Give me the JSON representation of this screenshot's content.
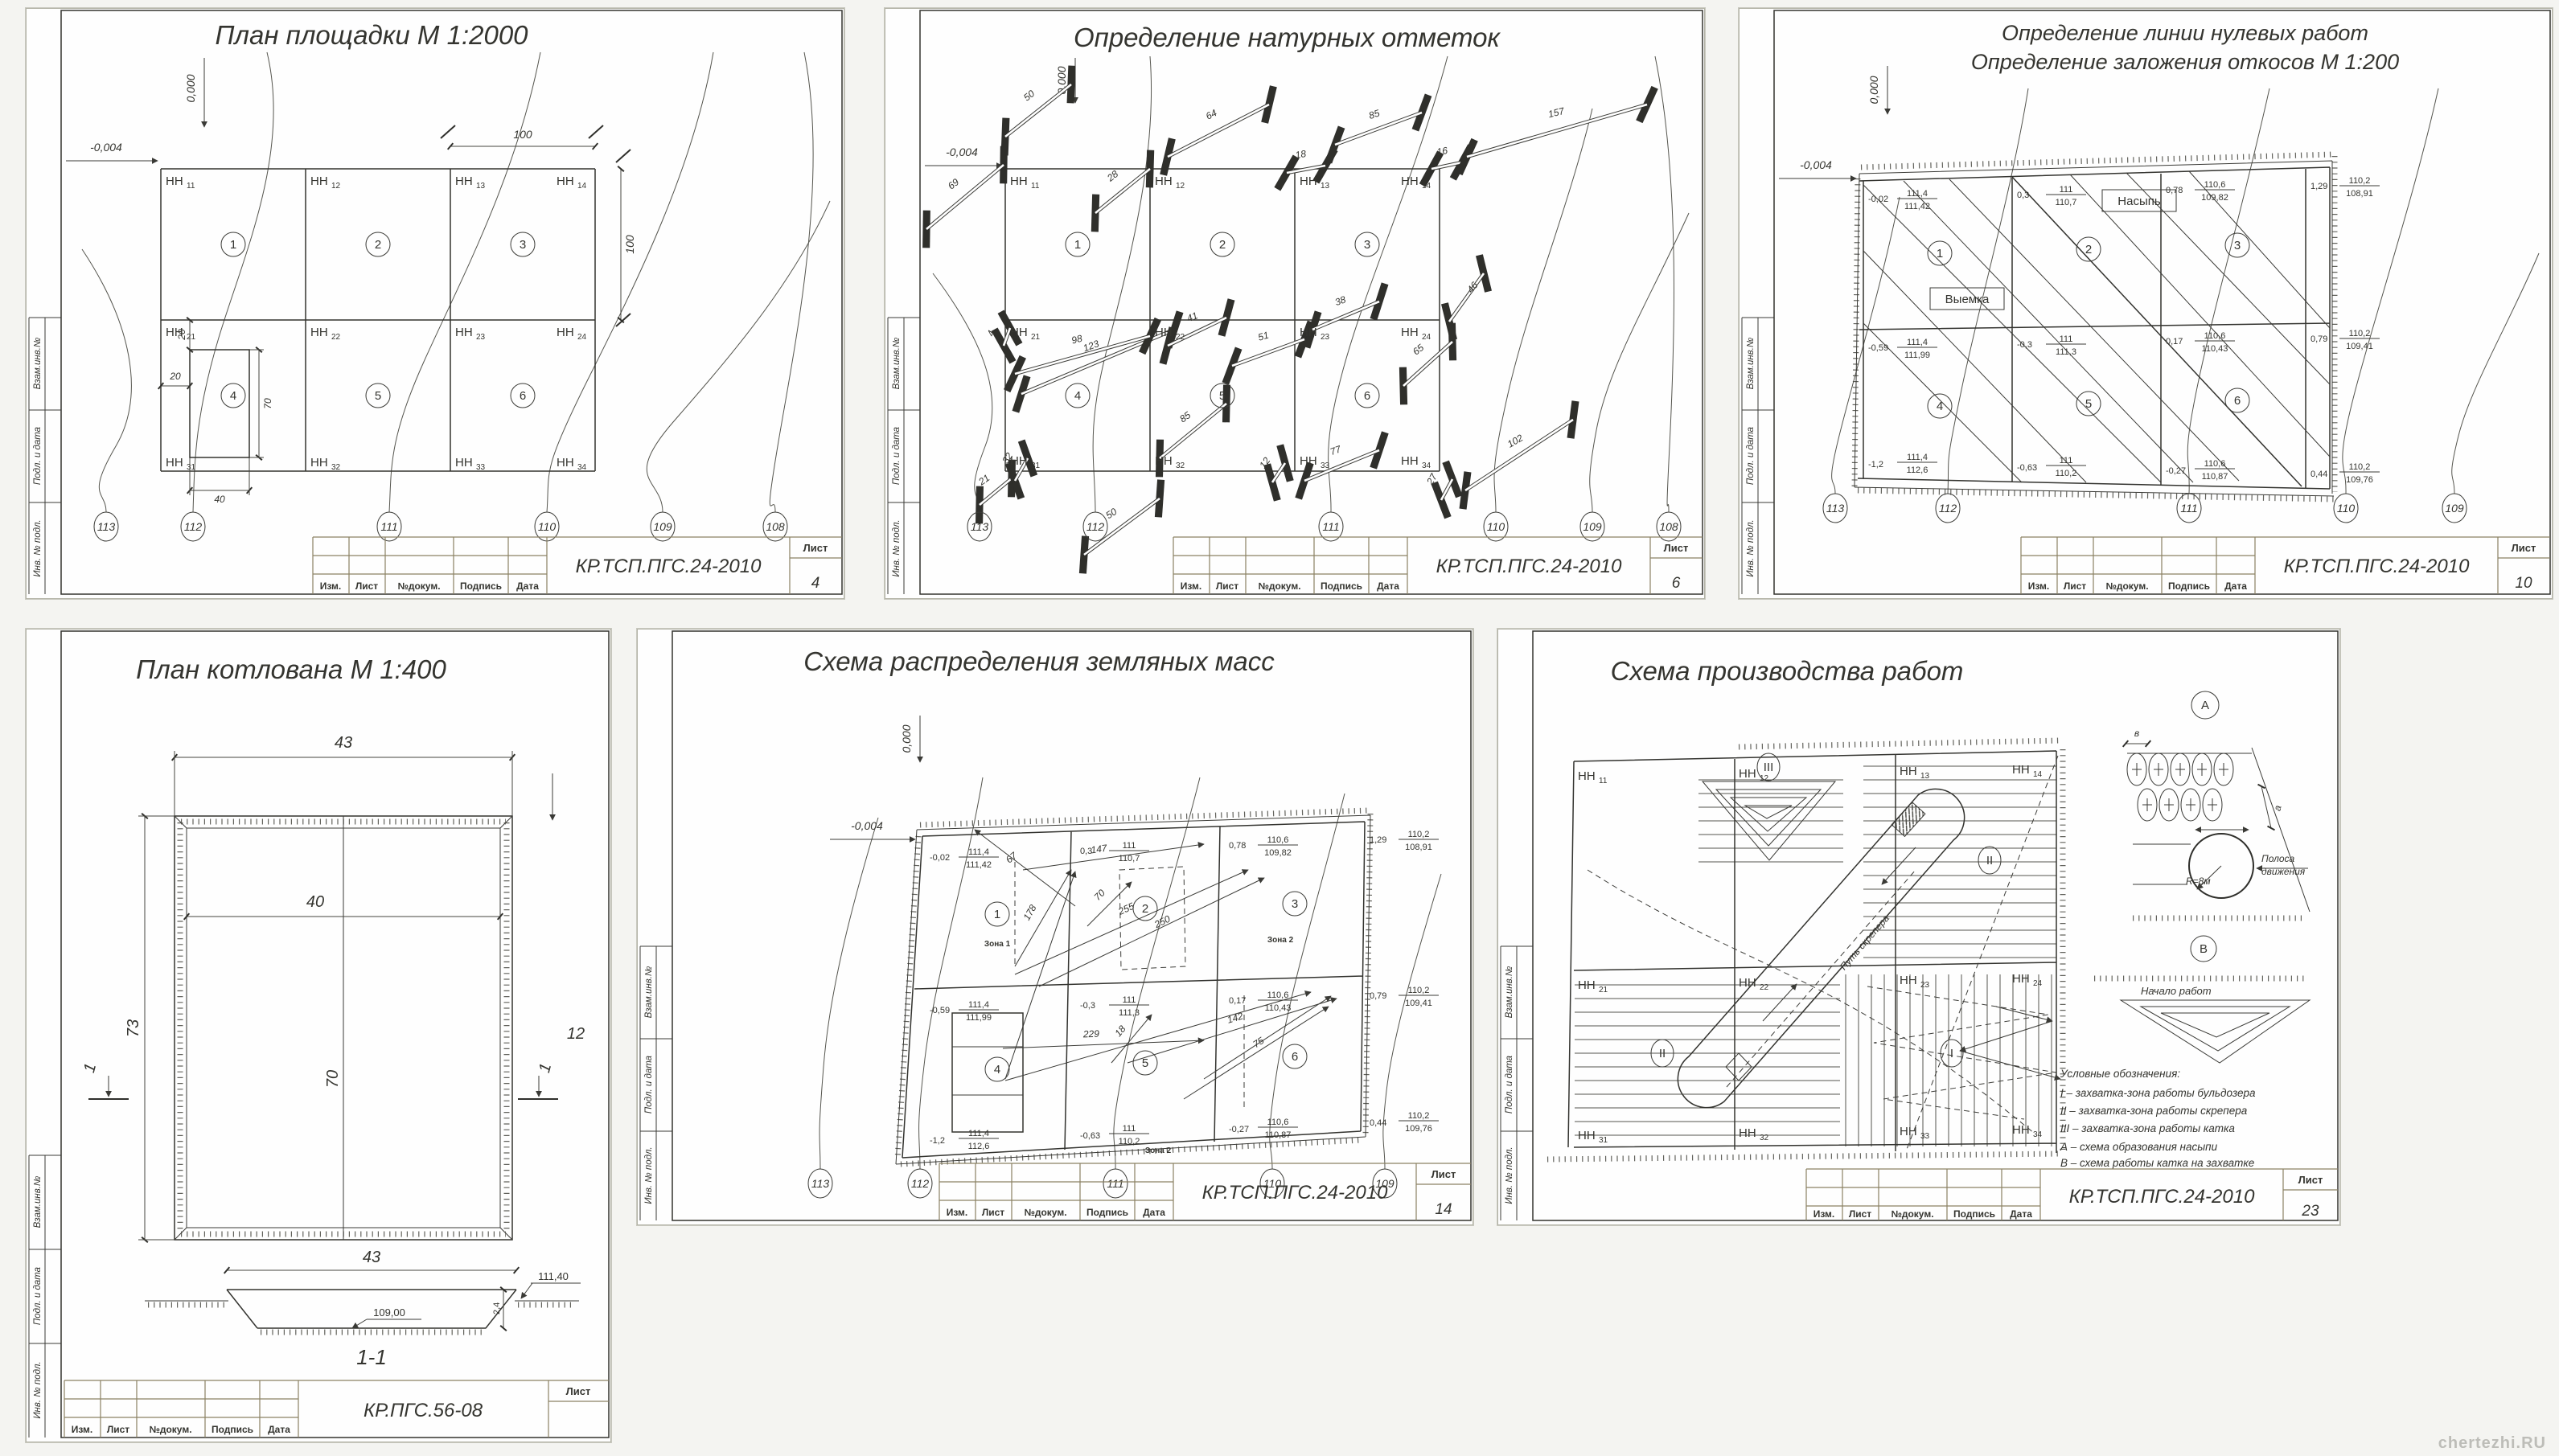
{
  "common": {
    "doc_code": "КР.ТСП.ПГС.24-2010",
    "doc_code_s4": "КР.ПГС.56-08",
    "tb_cols": [
      "Изм.",
      "Лист",
      "№докум.",
      "Подпись",
      "Дата"
    ],
    "sheet_word": "Лист",
    "side_labels": [
      "Взам.инв.№",
      "Подл. и дата",
      "Инв. № подл."
    ],
    "slope_v": "0,000",
    "slope_h": "-0,004",
    "hn": "НН",
    "sub": [
      [
        "11",
        "12",
        "13",
        "14"
      ],
      [
        "21",
        "22",
        "23",
        "24"
      ],
      [
        "31",
        "32",
        "33",
        "34"
      ]
    ],
    "cells": [
      "1",
      "2",
      "3",
      "4",
      "5",
      "6"
    ],
    "contours": [
      "113",
      "112",
      "111",
      "110",
      "109",
      "108"
    ],
    "nodes": [
      [
        {
          "w": "-0,02",
          "t": "111,4",
          "b": "111,42"
        },
        {
          "w": "0,3",
          "t": "111",
          "b": "110,7"
        },
        {
          "w": "0,78",
          "t": "110,6",
          "b": "109,82"
        },
        {
          "w": "1,29",
          "t": "110,2",
          "b": "108,91"
        }
      ],
      [
        {
          "w": "-0,59",
          "t": "111,4",
          "b": "111,99"
        },
        {
          "w": "-0,3",
          "t": "111",
          "b": "111,3"
        },
        {
          "w": "0,17",
          "t": "110,6",
          "b": "110,43"
        },
        {
          "w": "0,79",
          "t": "110,2",
          "b": "109,41"
        }
      ],
      [
        {
          "w": "-1,2",
          "t": "111,4",
          "b": "112,6"
        },
        {
          "w": "-0,63",
          "t": "111",
          "b": "110,2"
        },
        {
          "w": "-0,27",
          "t": "110,6",
          "b": "110,87"
        },
        {
          "w": "0,44",
          "t": "110,2",
          "b": "109,76"
        }
      ]
    ],
    "watermark": "chertezhi.RU"
  },
  "s1": {
    "title": "План площадки М 1:2000",
    "sheet_no": "4",
    "dim_100_top": "100",
    "dim_100_right": "100",
    "dim_20v": "20",
    "dim_20h": "20",
    "dim_70": "70",
    "dim_40": "40"
  },
  "s2": {
    "title": "Определение натурных отметок",
    "sheet_no": "6",
    "measures": [
      "50",
      "69",
      "28",
      "64",
      "18",
      "85",
      "16",
      "157",
      "123",
      "4",
      "98",
      "41",
      "51",
      "38",
      "46",
      "65",
      "21",
      "32",
      "85",
      "50",
      "12",
      "77",
      "27",
      "102"
    ]
  },
  "s3": {
    "title1": "Определение линии нулевых работ",
    "title2": "Определение заложения откосов М 1:200",
    "sheet_no": "10",
    "nasyp": "Насыпь",
    "vyemka": "Выемка"
  },
  "s4": {
    "title": "План котлована М 1:400",
    "sheet_no": "",
    "note": "12",
    "dim_top": "43",
    "dim_inner_top": "40",
    "dim_left": "73",
    "dim_inner_v": "70",
    "sec_mark": "1",
    "section_label": "1-1",
    "sec_dim_top": "43",
    "elev_bottom": "109,00",
    "elev_ground": "111,40",
    "depth": "2,4"
  },
  "s5": {
    "title": "Схема распределения земляных масс",
    "sheet_no": "14",
    "zones": [
      "Зона 1",
      "Зона 2",
      "Зона 2"
    ],
    "hauls": [
      "67",
      "147",
      "178",
      "70",
      "255",
      "250",
      "229",
      "18",
      "142",
      "75"
    ]
  },
  "s6": {
    "title": "Схема производства работ",
    "sheet_no": "23",
    "zone_marks": [
      "III",
      "II",
      "II",
      "I"
    ],
    "path_label": "Путь скрепера",
    "detail_a": {
      "id": "А",
      "dim_w": "в",
      "dim_a": "а",
      "radius": "R=8м",
      "strip1": "Полоса",
      "strip2": "движения"
    },
    "detail_b": {
      "id": "В",
      "start": "Начало работ"
    },
    "legend": {
      "heading": "Условные обозначения:",
      "items": [
        "I – захватка-зона работы бульдозера",
        "II – захватка-зона работы скрепера",
        "III – захватка-зона работы катка",
        "А – схема образования насыпи",
        "В – схема работы катка на захватке"
      ]
    }
  }
}
